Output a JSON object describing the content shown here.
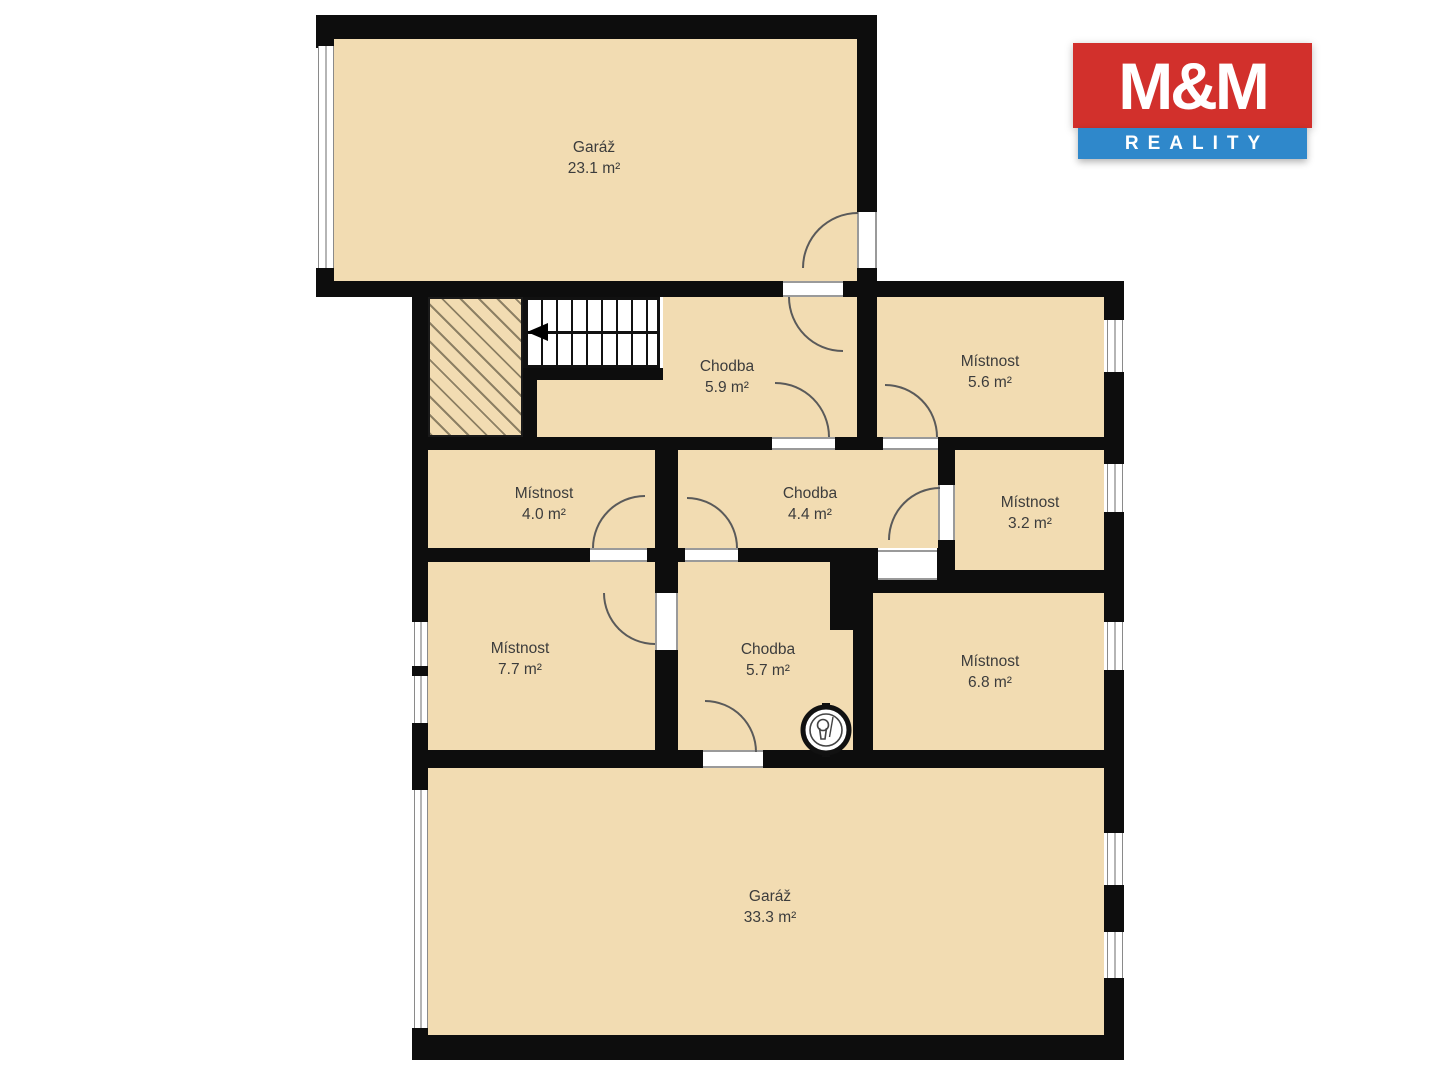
{
  "brand": {
    "name_top": "M&M",
    "name_bottom": "REALITY",
    "red": "#d2302c",
    "blue": "#2f88cb"
  },
  "plan": {
    "wall_color": "#0d0d0d",
    "floor_color": "#f2dcb2",
    "rooms": [
      {
        "id": "garage-top",
        "name": "Garáž",
        "area": "23.1 m²"
      },
      {
        "id": "chodba-59",
        "name": "Chodba",
        "area": "5.9 m²"
      },
      {
        "id": "mistnost-56",
        "name": "Místnost",
        "area": "5.6 m²"
      },
      {
        "id": "mistnost-40",
        "name": "Místnost",
        "area": "4.0 m²"
      },
      {
        "id": "chodba-44",
        "name": "Chodba",
        "area": "4.4 m²"
      },
      {
        "id": "mistnost-32",
        "name": "Místnost",
        "area": "3.2 m²"
      },
      {
        "id": "mistnost-77",
        "name": "Místnost",
        "area": "7.7 m²"
      },
      {
        "id": "chodba-57",
        "name": "Chodba",
        "area": "5.7 m²"
      },
      {
        "id": "mistnost-68",
        "name": "Místnost",
        "area": "6.8 m²"
      },
      {
        "id": "garage-bottom",
        "name": "Garáž",
        "area": "33.3 m²"
      }
    ]
  }
}
